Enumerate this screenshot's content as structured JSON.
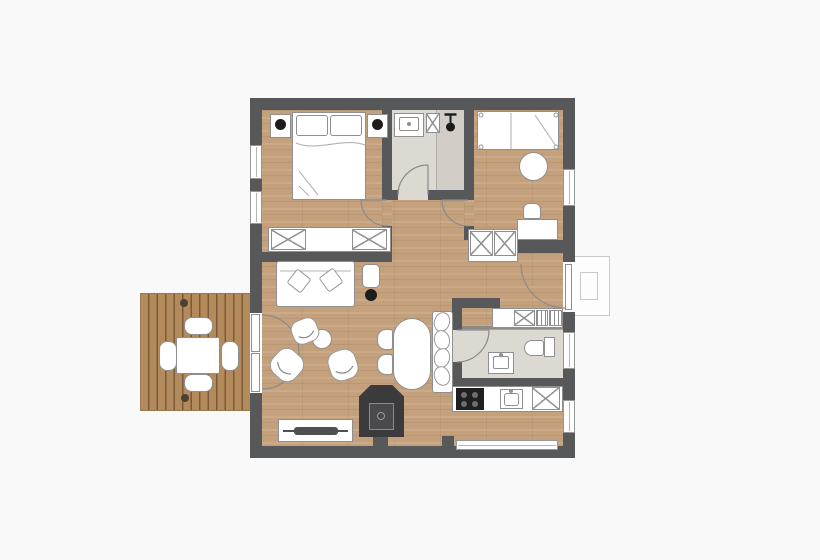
{
  "title": "apartment-floor-plan",
  "type": "architectural floor plan, top view, no text labels",
  "colors": {
    "background": "#f9f9f9",
    "wall": "#57585a",
    "wood_floor": "#c4a17c",
    "deck_wood": "#b28a5b",
    "tile_floor": "#dcd8d2",
    "shower_tile": "#d2cec7",
    "furniture_fill": "#ffffff",
    "furniture_line": "#8f8f8f",
    "accent_black": "#1d1d1e",
    "fireplace_body": "#3b3b3d",
    "fireplace_inner": "#4a4a4c",
    "porch_line": "#c9c9c9"
  },
  "rooms": [
    {
      "name": "bedroom-main",
      "position": "top-left",
      "items": [
        "double-bed",
        "pillow-left",
        "pillow-right",
        "nightstand-left",
        "nightstand-right",
        "bedside-lamp-left",
        "bedside-lamp-right",
        "wardrobe-two-doors",
        "window-1",
        "window-2",
        "door-to-hall"
      ]
    },
    {
      "name": "bathroom-shower",
      "position": "top-middle",
      "items": [
        "washbasin",
        "cabinet-x",
        "shower-head",
        "shower-partition",
        "door"
      ]
    },
    {
      "name": "bedroom-second",
      "position": "top-right",
      "items": [
        "single-bed",
        "round-rug",
        "desk",
        "desk-chair",
        "window-right",
        "door-to-hall"
      ]
    },
    {
      "name": "hallway",
      "position": "center",
      "items": [
        "wardrobe-two-doors",
        "entrance-door",
        "entrance-porch"
      ]
    },
    {
      "name": "living-room",
      "position": "left",
      "items": [
        "sofa",
        "throw-pillows",
        "side-table",
        "floor-lamp",
        "armchair-1",
        "armchair-2",
        "armchair-3",
        "round-coffee-table",
        "sideboard",
        "soundbar",
        "wood-stove",
        "french-doors-to-deck"
      ]
    },
    {
      "name": "dining-area",
      "position": "center-bottom",
      "items": [
        "dining-table",
        "chair-1",
        "chair-2",
        "bench-with-cushions"
      ]
    },
    {
      "name": "bathroom-second",
      "position": "right",
      "items": [
        "toilet",
        "washbasin",
        "window",
        "door",
        "laundry-counter",
        "washer-x",
        "dryer-hatched"
      ]
    },
    {
      "name": "kitchen",
      "position": "bottom-right",
      "items": [
        "cooktop-4-burners",
        "kitchen-sink",
        "refrigerator-x",
        "window-right",
        "window-bottom"
      ]
    },
    {
      "name": "deck",
      "position": "outside-left",
      "items": [
        "outdoor-table",
        "outdoor-chair-north",
        "outdoor-chair-south",
        "outdoor-chair-west",
        "outdoor-chair-east",
        "post-north",
        "post-south"
      ]
    }
  ]
}
